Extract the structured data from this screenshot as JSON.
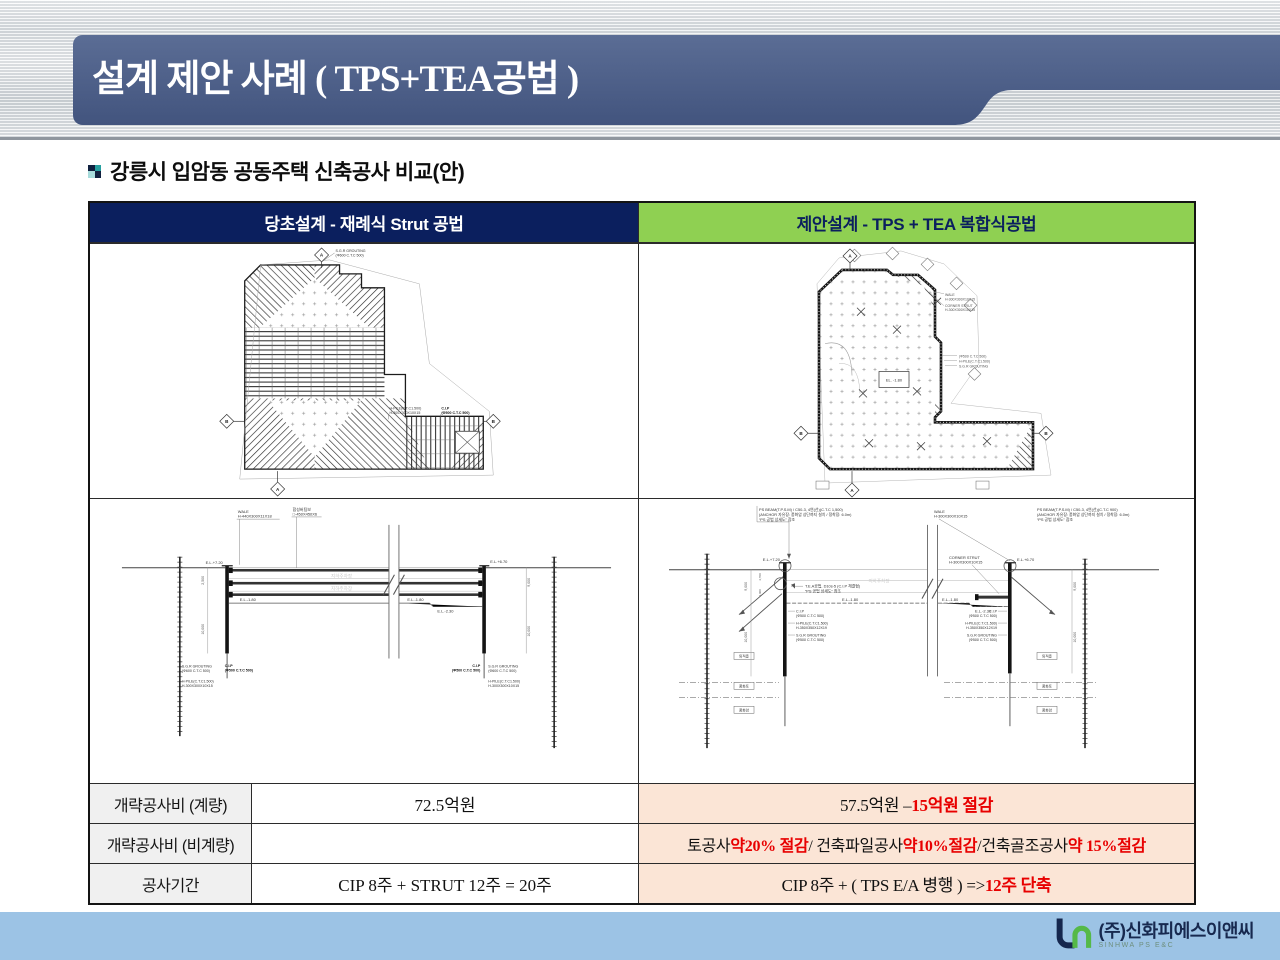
{
  "slide": {
    "title": "설계 제안 사례 ( TPS+TEA공법 )",
    "subtitle": "강릉시 입암동 공동주택 신축공사 비교(안)"
  },
  "table": {
    "header_left": "당초설계 - 재례식 Strut 공법",
    "header_right": "제안설계 - TPS + TEA 복합식공법",
    "rows": [
      {
        "label": "개략공사비 (계량)",
        "middle": "72.5억원",
        "right": [
          {
            "t": "57.5억원 – "
          },
          {
            "t": "15억원 절감",
            "red": true
          }
        ]
      },
      {
        "label": "개략공사비 (비계량)",
        "middle": "",
        "right": [
          {
            "t": "토공사 "
          },
          {
            "t": "약20% 절감",
            "red": true
          },
          {
            "t": " / 건축파일공사  "
          },
          {
            "t": "약10%절감",
            "red": true
          },
          {
            "t": " /건축골조공사  "
          },
          {
            "t": "약 15%절감",
            "red": true
          }
        ]
      },
      {
        "label": "공사기간",
        "middle": "CIP 8주 + STRUT 12주 = 20주",
        "right": [
          {
            "t": "CIP 8주 + ( TPS  E/A 병행 ) =>  "
          },
          {
            "t": "12주 단축",
            "red": true
          }
        ]
      }
    ]
  },
  "drawings": {
    "common": {
      "el720": "E.L.+7.20",
      "el670": "E.L.+6.70",
      "elm180": "E.L.-1.80",
      "elm230": "E.L.-2.30",
      "cip": "C.I.P",
      "cip500": "(Φ500 C.T.C 500)",
      "sgr": "S.G.R GROUTING",
      "sgr600": "(Φ600 C.T.C 500)",
      "hpile": "H-PILE(C.T.C1.500)",
      "h300": "H-300X300X10X15",
      "h350": "H-350X350X12X19",
      "wale": "WALE",
      "w440": "H-440X300X11X18",
      "parking": "지하주차장",
      "marker_a": "A",
      "marker_b": "B",
      "d10000": "10,000",
      "d9000": "9,000",
      "d2500": "2,500",
      "d4700": "4,700",
      "d4300": "4,300",
      "el_box": "EL. -1.80"
    },
    "left_section": {
      "strut_label": "합성버팀보",
      "strut_spec": "□-450X450X6"
    },
    "right_plan": {
      "corner": "CORNER STRUT"
    },
    "right_section": {
      "ps1500": "PS BEAM(T.P.S.M) / C50-3, 4연(선)(C.T.C 1,500)",
      "ps900": "PS BEAM(T.P.S.M) / C50-3, 4연(선)(C.T.C 900)",
      "anchor_note": "(ANCHOR 자유장: 풍화암 상단까지 설치 / 정착장: 6.0m)",
      "refer": "“PS 공법 상세도” 참조",
      "tea": "T.E.A공법, D10s-5 (C.I.P 체결형)",
      "soil": [
        "퇴적층",
        "풍화토",
        "풍화암"
      ]
    }
  },
  "footer": {
    "company": "(주)신화피에스이앤씨",
    "company_en": "SINHWA PS E&C"
  }
}
